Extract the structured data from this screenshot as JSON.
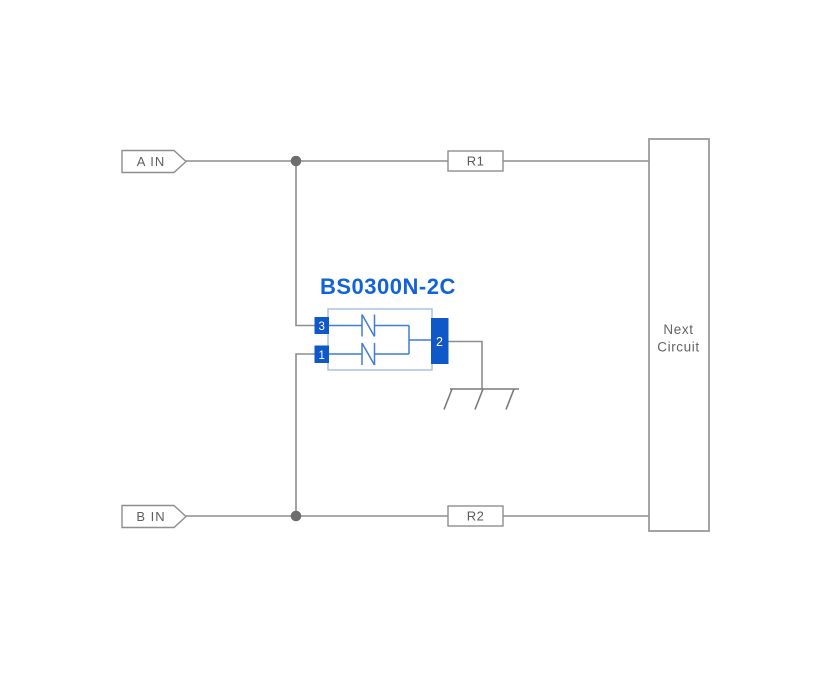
{
  "diagram": {
    "inputs": {
      "a": {
        "label": "A IN"
      },
      "b": {
        "label": "B IN"
      }
    },
    "resistors": {
      "r1": {
        "label": "R1"
      },
      "r2": {
        "label": "R2"
      }
    },
    "next_circuit": {
      "line1": "Next",
      "line2": "Circuit"
    },
    "component": {
      "name": "BS0300N-2C",
      "pins": {
        "top_left": "3",
        "bottom_left": "1",
        "right": "2"
      }
    }
  },
  "colors": {
    "wire_gray": "#8e8e8e",
    "junction_gray": "#6e6e6e",
    "label_gray": "#5f5f5f",
    "pin_blue": "#0f58c8",
    "name_blue": "#1263d9",
    "body_border_blue": "#a8c3e6",
    "diode_blue": "#3f7cd6"
  }
}
